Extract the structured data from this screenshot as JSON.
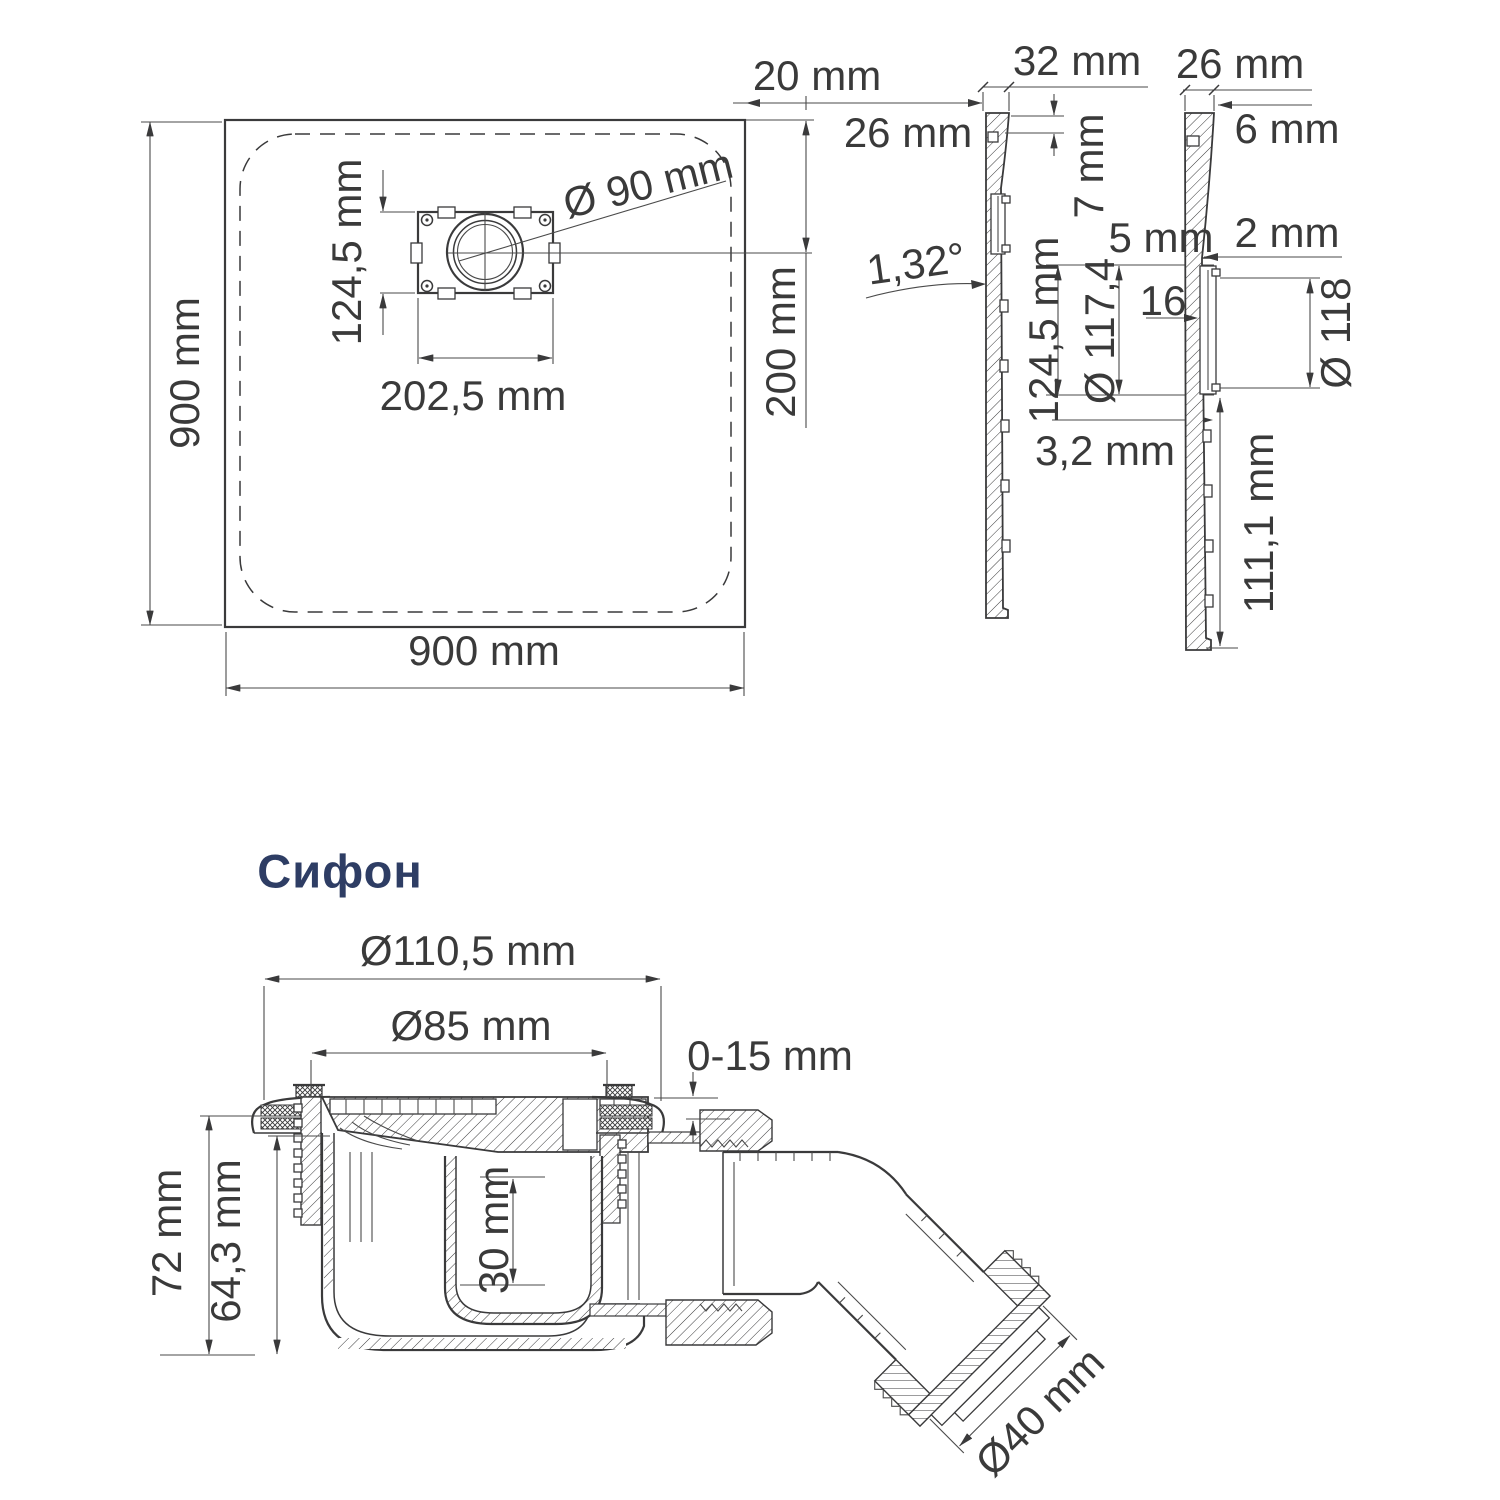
{
  "colors": {
    "line": "#3a3a3b",
    "accent": "#2e3d64",
    "background": "#ffffff"
  },
  "tray_plan": {
    "side_length": "900 mm",
    "bottom_length": "900 mm",
    "drain_box_height": "124,5 mm",
    "drain_box_width": "202,5 mm",
    "drain_diameter": "Ø 90 mm",
    "drain_offset_top": "20 mm",
    "edge_thickness": "26 mm",
    "drain_center_from_edge": "200 mm"
  },
  "section_left": {
    "top_width": "32 mm",
    "lip_height": "7 mm",
    "slope_angle": "1,32°",
    "drain_opening_height": "124,5 mm",
    "lip_offset": "5 mm",
    "drain_opening_diameter": "Ø 117,4",
    "bottom_thickness": "3,2 mm"
  },
  "section_right": {
    "top_width": "26 mm",
    "top_edge": "6 mm",
    "step": "2 mm",
    "notch": "16",
    "drain_opening_diameter": "Ø 118",
    "lower_part_height": "111,1 mm"
  },
  "siphon": {
    "title": "Сифон",
    "flange_diameter": "Ø110,5 mm",
    "bowl_diameter": "Ø85 mm",
    "adjustment_range": "0-15 mm",
    "total_height": "72 mm",
    "body_height": "64,3 mm",
    "cup_depth": "30 mm",
    "outlet_diameter": "Ø40 mm"
  }
}
